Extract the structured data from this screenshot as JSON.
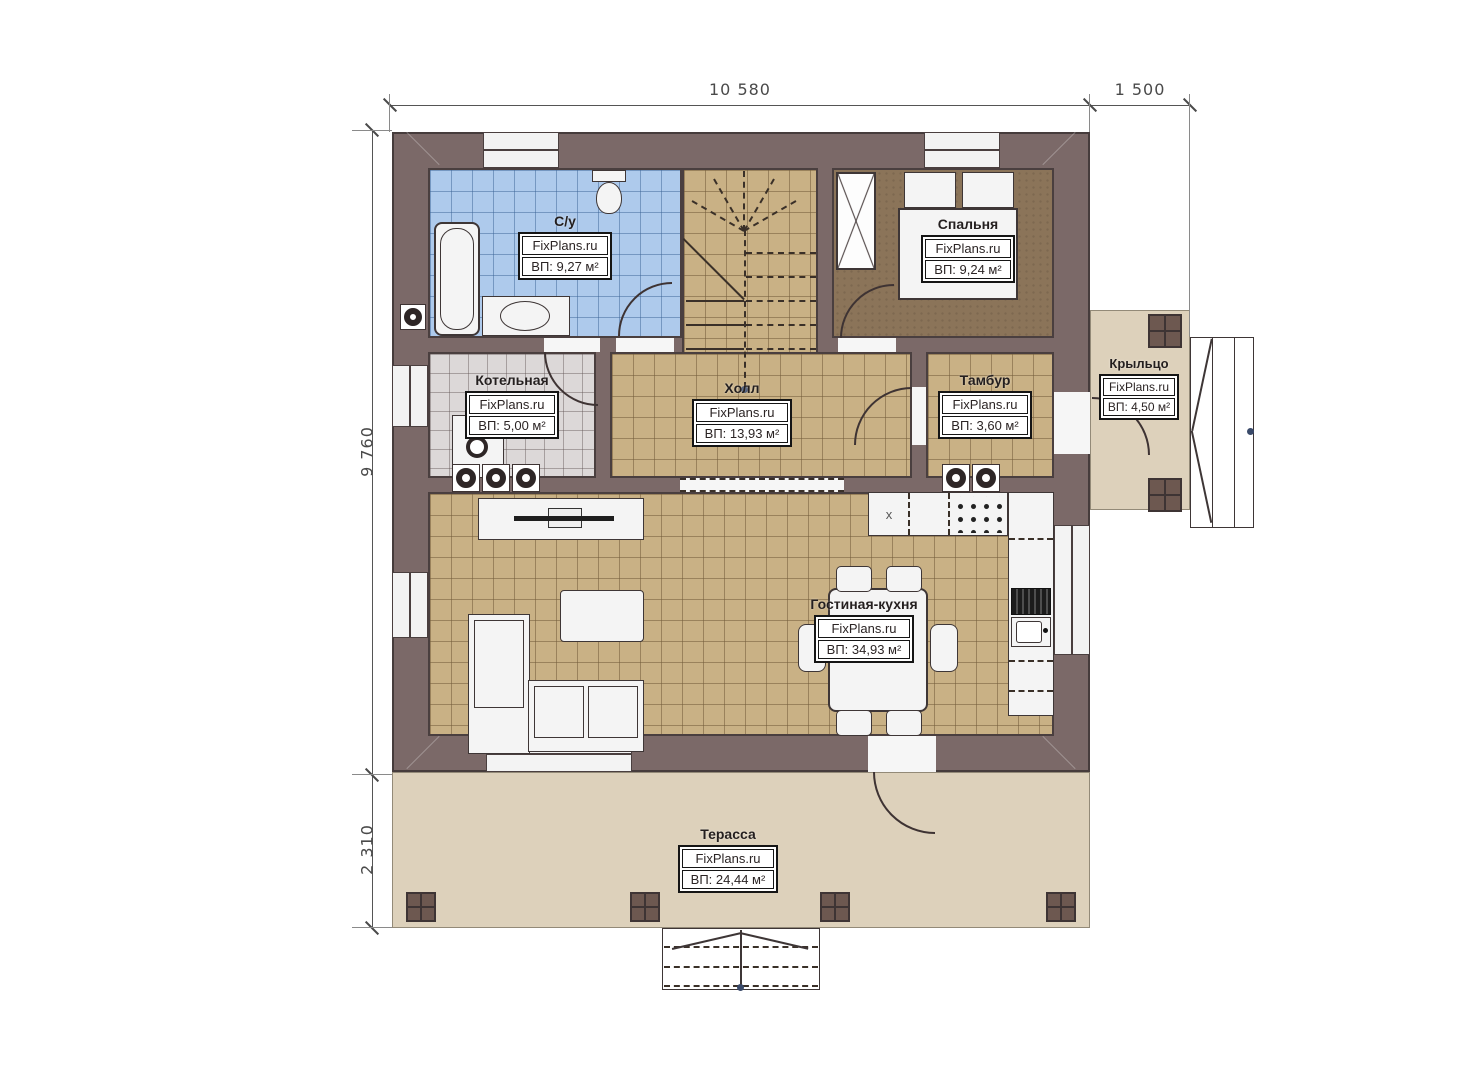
{
  "dimensions": {
    "width_main": "10 580",
    "width_porch": "1 500",
    "height_main": "9 760",
    "height_terrace": "2 310"
  },
  "rooms": [
    {
      "id": "bathroom",
      "name": "С/у",
      "watermark": "FixPlans.ru",
      "area": "ВП: 9,27 м²"
    },
    {
      "id": "bedroom",
      "name": "Спальня",
      "watermark": "FixPlans.ru",
      "area": "ВП: 9,24 м²"
    },
    {
      "id": "boiler",
      "name": "Котельная",
      "watermark": "FixPlans.ru",
      "area": "ВП: 5,00 м²"
    },
    {
      "id": "hall",
      "name": "Холл",
      "watermark": "FixPlans.ru",
      "area": "ВП: 13,93 м²"
    },
    {
      "id": "vestibule",
      "name": "Тамбур",
      "watermark": "FixPlans.ru",
      "area": "ВП: 3,60 м²"
    },
    {
      "id": "porch",
      "name": "Крыльцо",
      "watermark": "FixPlans.ru",
      "area": "ВП: 4,50 м²"
    },
    {
      "id": "living_kitchen",
      "name": "Гостиная-кухня",
      "watermark": "FixPlans.ru",
      "area": "ВП: 34,93 м²"
    },
    {
      "id": "terrace",
      "name": "Терасса",
      "watermark": "FixPlans.ru",
      "area": "ВП: 24,44 м²"
    }
  ],
  "annotations": {
    "kitchen_appliance_label": "x"
  },
  "colors": {
    "wall": "#7b6968",
    "bathroom_floor": "#aecaec",
    "boiler_floor": "#dcd8d8",
    "wood_tile_floor": "#c9b185",
    "bedroom_floor": "#8b7459",
    "terrace_floor": "#ddd1bb",
    "outline": "#3e3333"
  }
}
